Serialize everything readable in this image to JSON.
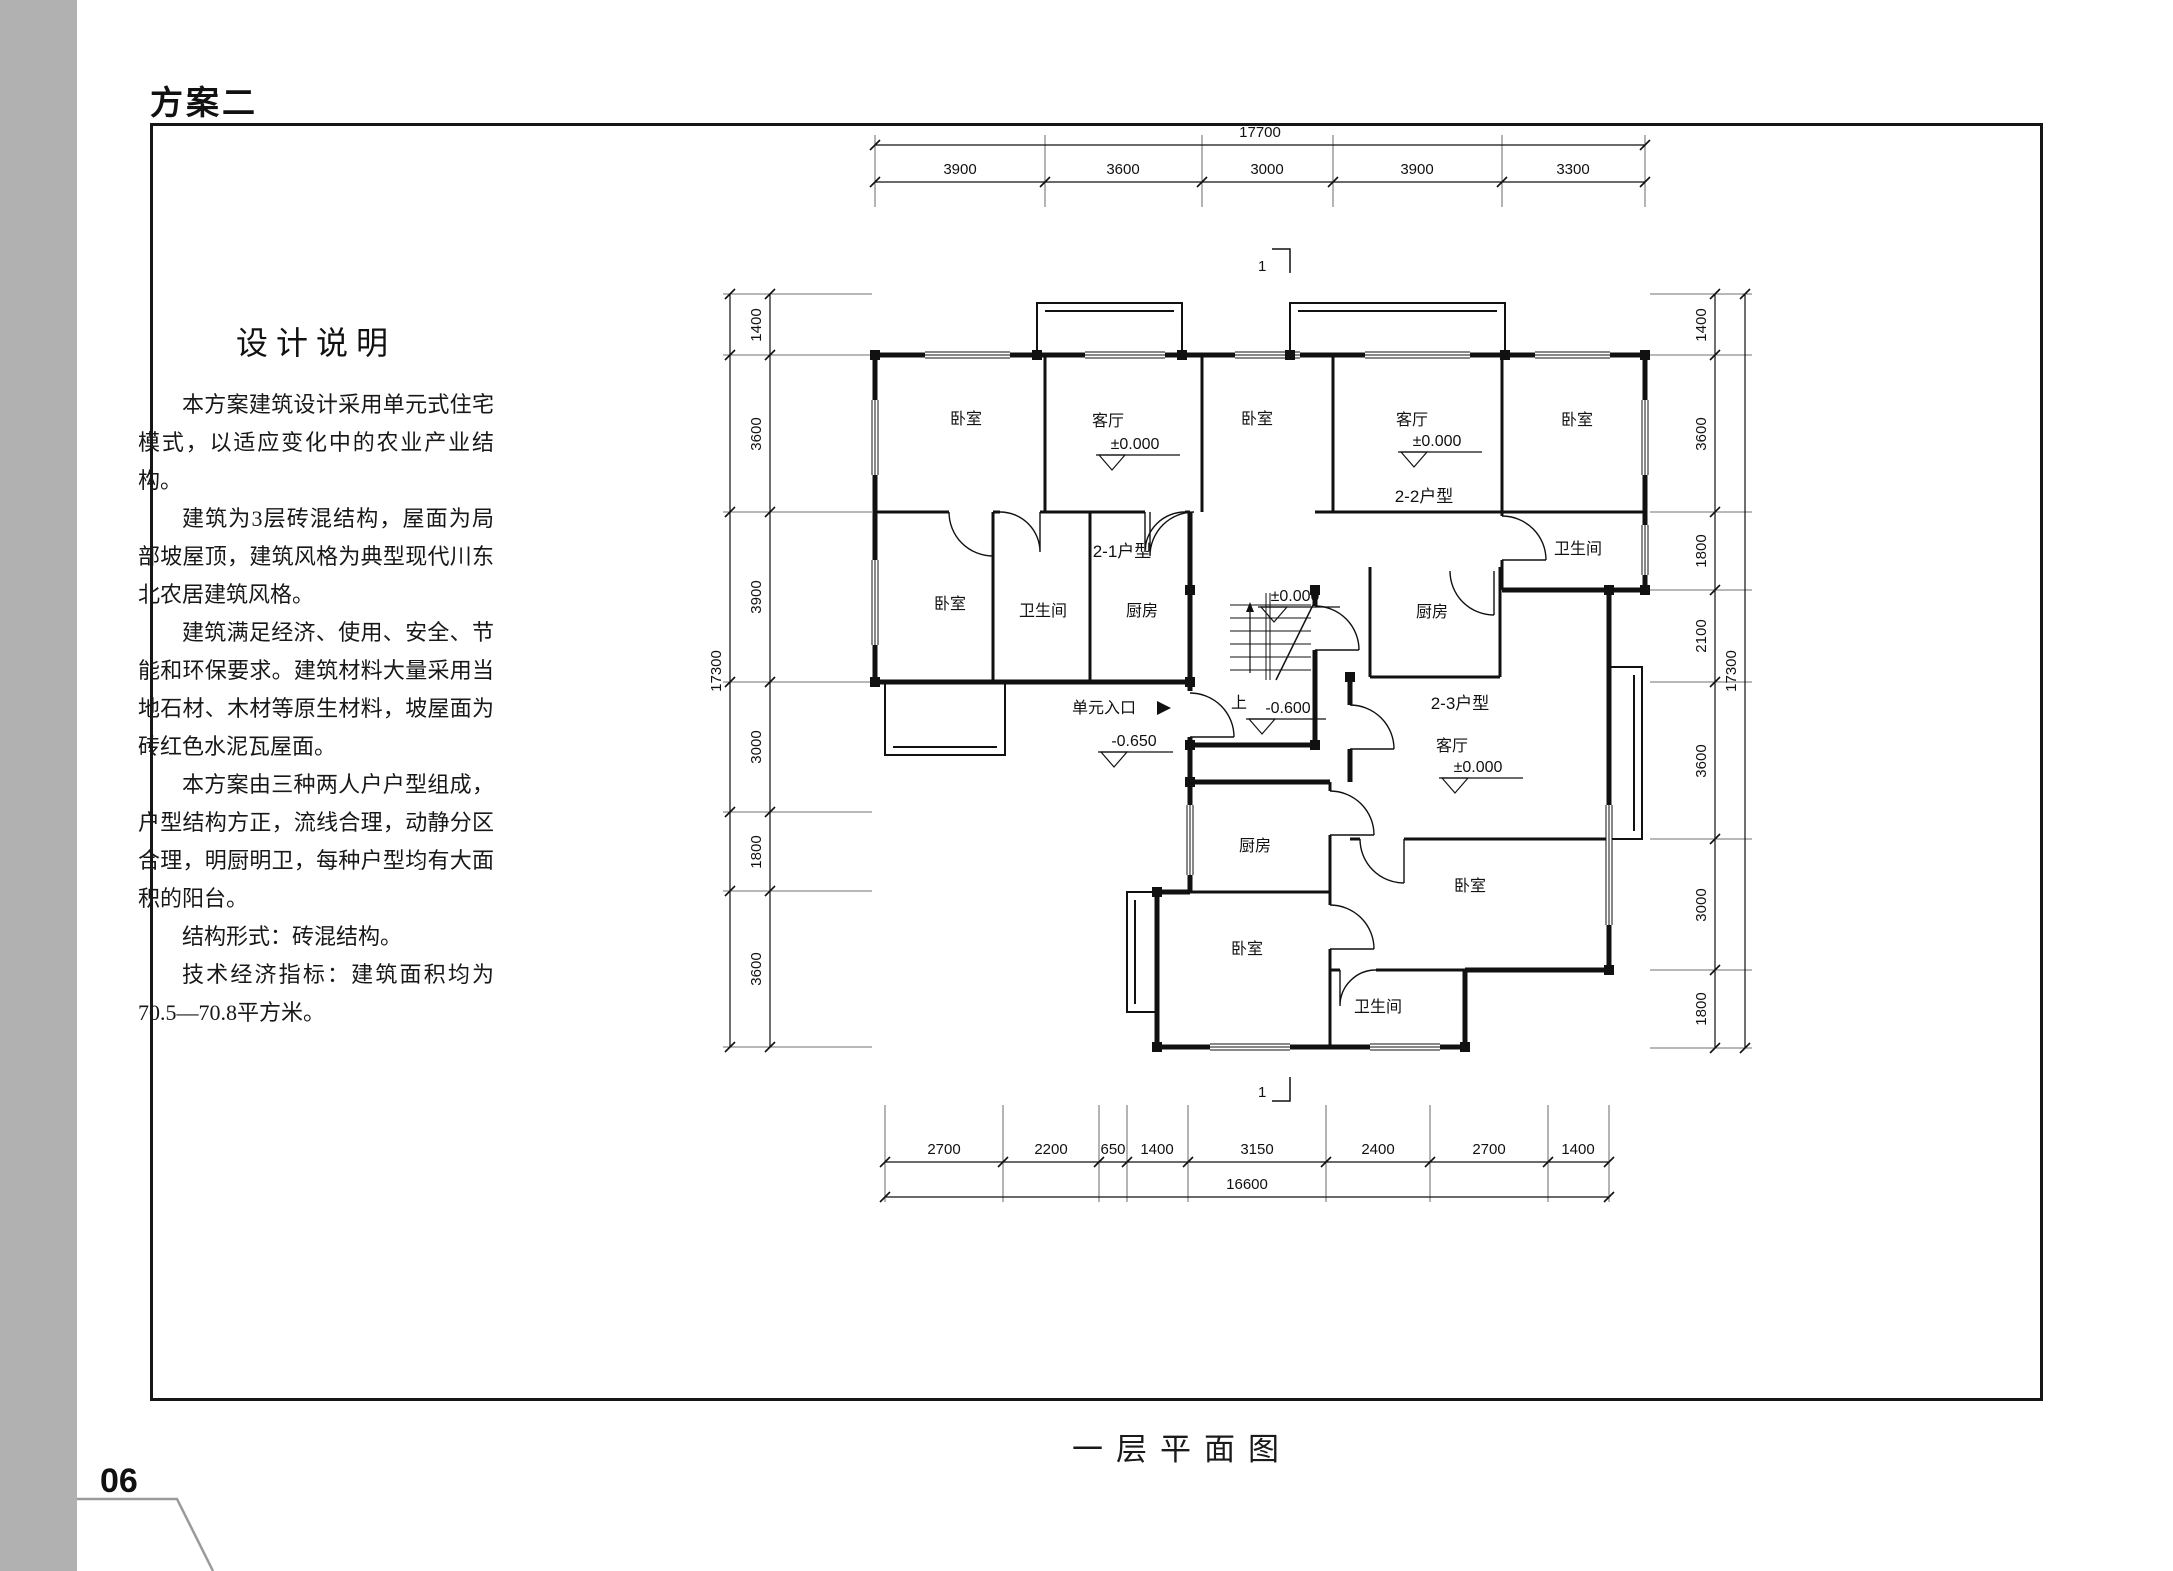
{
  "page": {
    "header_title": "方案二",
    "caption": "一层平面图",
    "page_number": "06",
    "accent_gray": "#b1b1b1"
  },
  "design_notes": {
    "title": "设计说明",
    "paragraphs": [
      "本方案建筑设计采用单元式住宅模式，以适应变化中的农业产业结构。",
      "建筑为3层砖混结构，屋面为局部坡屋顶，建筑风格为典型现代川东北农居建筑风格。",
      "建筑满足经济、使用、安全、节能和环保要求。建筑材料大量采用当地石材、木材等原生材料，坡屋面为砖红色水泥瓦屋面。",
      "本方案由三种两人户户型组成，户型结构方正，流线合理，动静分区合理，明厨明卫，每种户型均有大面积的阳台。",
      "结构形式：砖混结构。",
      "技术经济指标：建筑面积均为70.5—70.8平方米。"
    ]
  },
  "plan": {
    "section_marker": "1",
    "entrance": "单元入口",
    "units": {
      "u21": "2-1户型",
      "u22": "2-2户型",
      "u23": "2-3户型"
    },
    "rooms": {
      "bedroom": "卧室",
      "living": "客厅",
      "bath": "卫生间",
      "kitchen": "厨房"
    },
    "levels": {
      "zero": "±0.000",
      "m600": "-0.600",
      "m650": "-0.650",
      "up": "上"
    },
    "dims": {
      "top": {
        "total": "17700",
        "segments": [
          "3900",
          "3600",
          "3000",
          "3900",
          "3300"
        ]
      },
      "bottom": {
        "total": "16600",
        "segments": [
          "2700",
          "2200",
          "650",
          "1400",
          "3150",
          "2400",
          "2700",
          "1400"
        ]
      },
      "left": {
        "total": "17300",
        "segments": [
          "1400",
          "3600",
          "3900",
          "3000",
          "1800",
          "3600"
        ]
      },
      "right": {
        "total": "17300",
        "segments": [
          "1400",
          "3600",
          "1800",
          "2100",
          "3600",
          "3000",
          "1800"
        ]
      }
    }
  }
}
